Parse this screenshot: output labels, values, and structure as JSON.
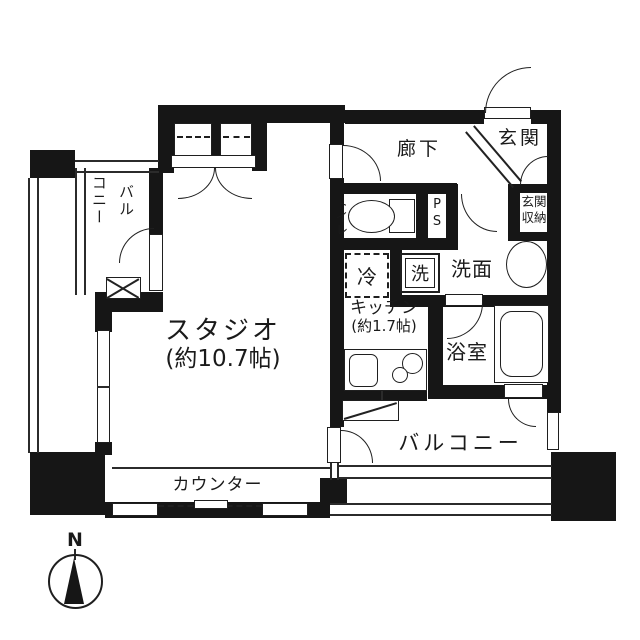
{
  "title": "floor-plan",
  "labels": {
    "studio": "スタジオ",
    "studio_size": "(約10.7帖)",
    "kitchen": "キッチン",
    "kitchen_size": "(約1.7帖)",
    "hallway": "廊下",
    "entrance": "玄関",
    "entrance_storage": "玄関収納",
    "entrance_storage_l1": "玄関",
    "entrance_storage_l2": "収納",
    "toilet": "トイレ",
    "ps": "PS",
    "ps_l1": "P",
    "ps_l2": "S",
    "fridge": "冷",
    "washer": "洗",
    "washroom": "洗面",
    "bathroom": "浴室",
    "balcony": "バルコニー",
    "balcony_left_col_left": "コニー",
    "balcony_left_col_right": "バル",
    "counter": "カウンター",
    "compass_n": "N"
  },
  "colors": {
    "wall": "#161616",
    "line": "#2b2b2b",
    "background": "#ffffff"
  }
}
